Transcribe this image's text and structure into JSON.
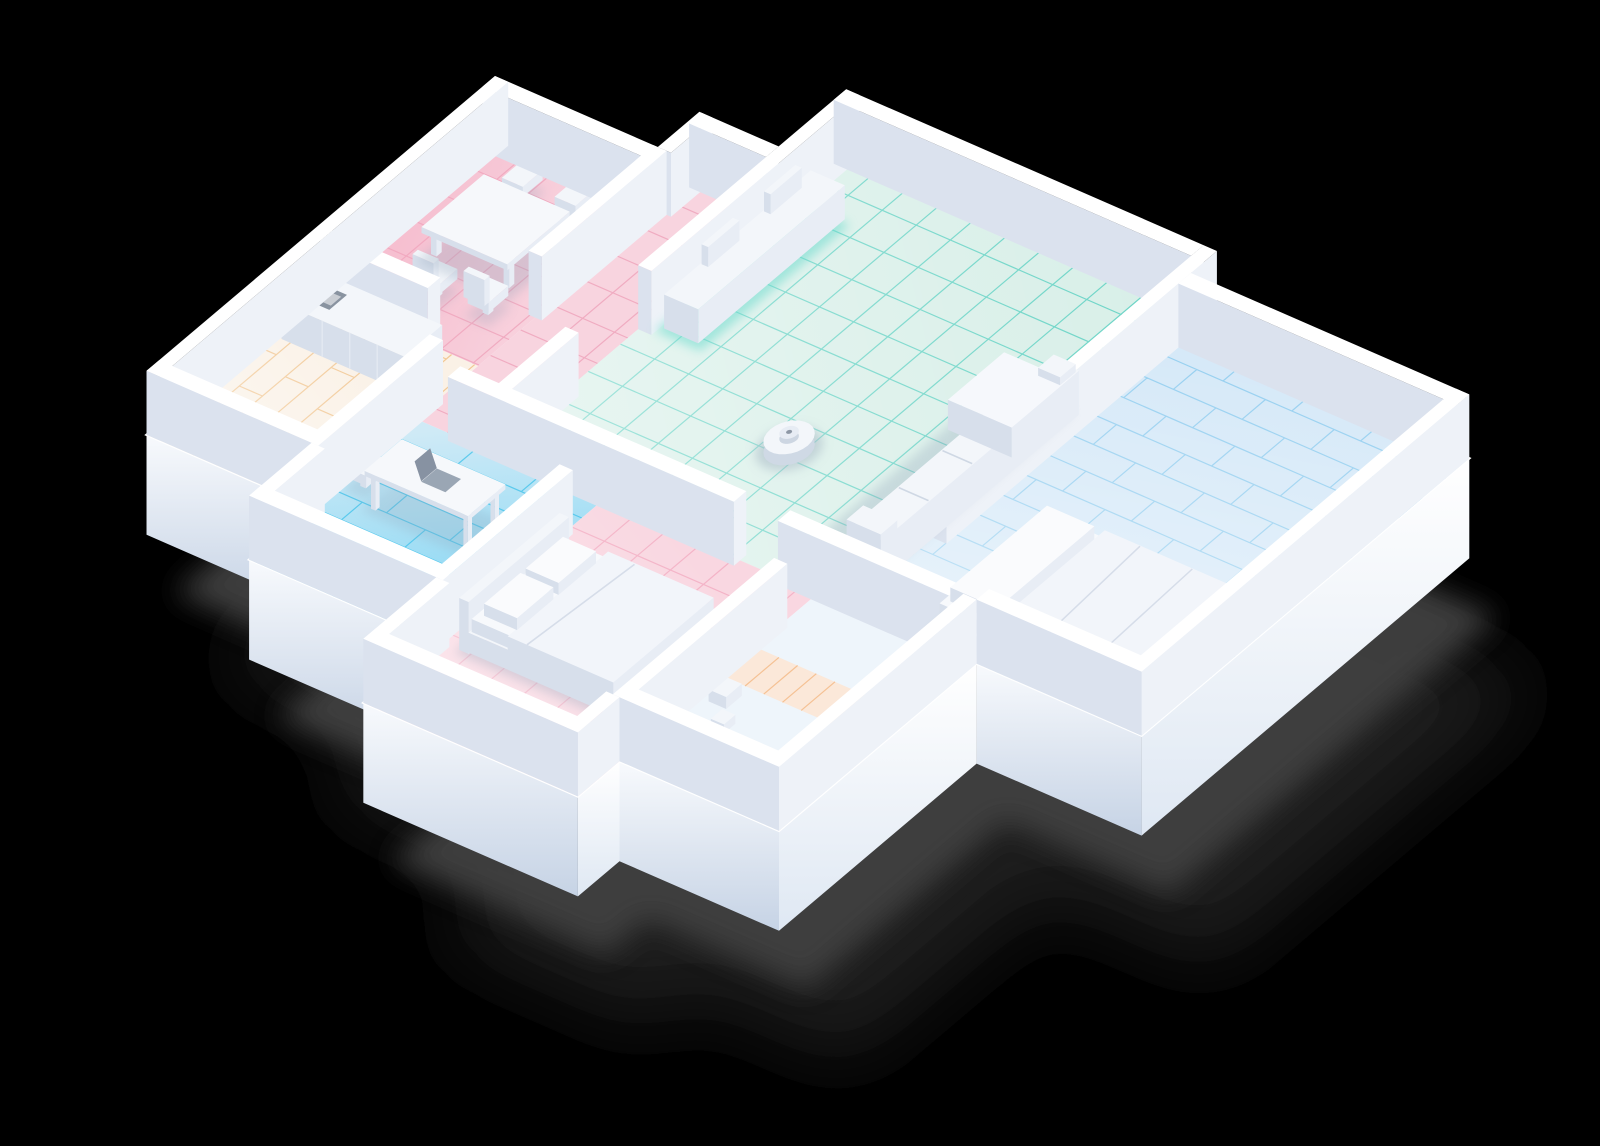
{
  "scene": {
    "label": "Isometric 3D apartment floor-plan render with robot vacuum",
    "background": "#000000"
  },
  "palette": {
    "background": "#000000",
    "shadow_core": "#414141",
    "shadow_soft": "#232323",
    "slab_sw_top": "#f8fafd",
    "slab_sw_bottom": "#c6d3e5",
    "slab_se_top": "#ffffff",
    "slab_se_bottom": "#dfe8f3",
    "deck": "#fbfcff",
    "wall_top": "#ffffff",
    "wall_sw": "#dbe2ee",
    "wall_se": "#eef2f8",
    "furn_top": "#f3f6fa",
    "furn_sw": "#d7dfeb",
    "furn_se": "#e8edf5",
    "mattress_top": "#f7f9fc",
    "soft_shadow": "#8fa3b8",
    "glow_teal": "#5fd8c9",
    "cooktop_dark": "#6e7a89",
    "laptop_base": "#9aa6b4",
    "laptop_screen": "#8792a2",
    "robot_body": "#f3f6fa",
    "robot_side": "#cfd9e5",
    "robot_turret": "#e7ecf4",
    "robot_dot": "#8d97a5",
    "robot_shadow": "#a9bac6"
  },
  "rooms": [
    {
      "id": "dining-room",
      "floor": "pink-ceramic-tiles",
      "base": "#f8d4df",
      "line": "#efa5bc"
    },
    {
      "id": "entry-hall",
      "floor": "pink-ceramic-tiles",
      "base": "#f8d4df",
      "line": "#efa5bc"
    },
    {
      "id": "living-room",
      "floor": "mint-ceramic-tiles",
      "base": "#d8efe8",
      "line": "#57cfc0"
    },
    {
      "id": "kitchen",
      "floor": "cream-wood-planks",
      "base": "#faf1e6",
      "line": "#f0c186"
    },
    {
      "id": "study",
      "floor": "cyan-wood-planks",
      "base": "#cfeaf6",
      "line": "#4cc6ea"
    },
    {
      "id": "bedroom-south",
      "floor": "pink-ceramic-tiles",
      "base": "#f9d7e1",
      "line": "#f3adc2"
    },
    {
      "id": "utility-room",
      "floor": "pale-floor-peach-planks",
      "base": "#eef5fb",
      "line": "#f4bc8c",
      "strip": "#fbe8d9"
    },
    {
      "id": "bedroom-east",
      "floor": "blue-wood-planks",
      "base": "#d6e9f8",
      "line": "#8ccbee"
    }
  ],
  "objects": [
    {
      "id": "dining-table"
    },
    {
      "id": "dining-chair"
    },
    {
      "id": "kitchen-counter"
    },
    {
      "id": "cooktop-icon"
    },
    {
      "id": "tv-sideboard"
    },
    {
      "id": "sofa"
    },
    {
      "id": "bed-south"
    },
    {
      "id": "bed-east"
    },
    {
      "id": "pillow"
    },
    {
      "id": "desk"
    },
    {
      "id": "desk-chair"
    },
    {
      "id": "laptop"
    },
    {
      "id": "utility-items"
    },
    {
      "id": "robot-vacuum"
    }
  ]
}
